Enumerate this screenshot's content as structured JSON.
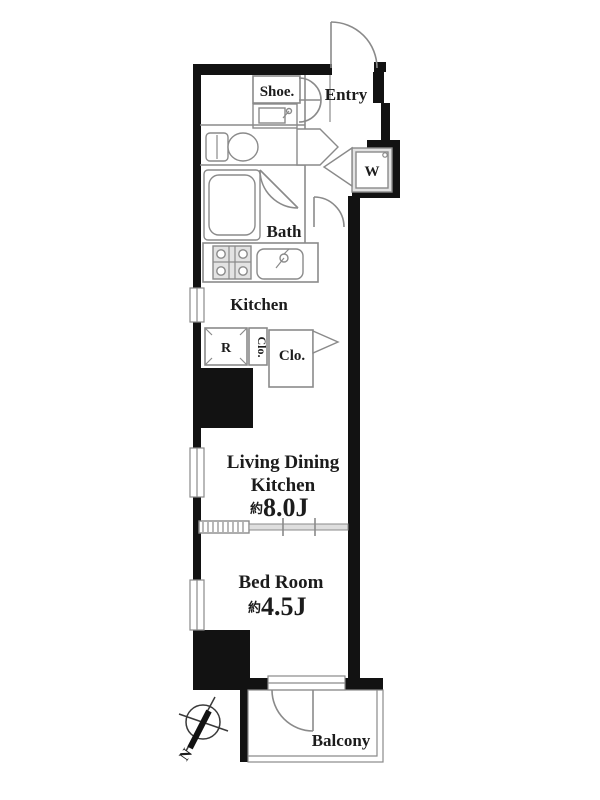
{
  "plan": {
    "labels": {
      "shoe": "Shoe.",
      "entry": "Entry",
      "washer": "W",
      "bath": "Bath",
      "kitchen": "Kitchen",
      "fridge": "R",
      "closet_vertical": "Clo.",
      "closet": "Clo.",
      "ldk_line1": "Living Dining",
      "ldk_line2": "Kitchen",
      "ldk_size_prefix": "約",
      "ldk_size": "8.0J",
      "bedroom": "Bed Room",
      "bedroom_size_prefix": "約",
      "bedroom_size": "4.5J",
      "balcony": "Balcony",
      "compass_north": "N"
    },
    "colors": {
      "wall": "#121212",
      "line": "#8a8a8a",
      "fixture": "#e3e3e3",
      "text": "#1c1c1c"
    }
  }
}
